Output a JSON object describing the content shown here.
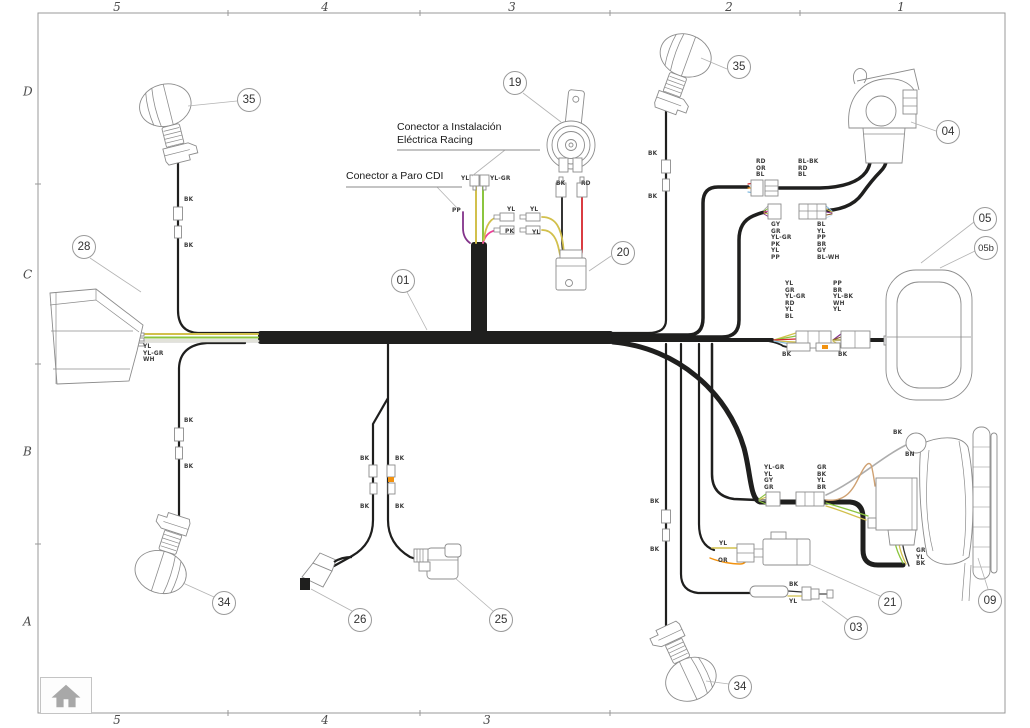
{
  "colors": {
    "BK": "#1f1f1e",
    "YL": "#d2c04c",
    "YL-GR": "#8bc53f",
    "YL-BK": "#9a8a22",
    "WH": "#f2f1ea",
    "RD": "#d6272e",
    "OR": "#f2920f",
    "PP": "#83338a",
    "PK": "#ec3f97",
    "BL": "#85bbdf",
    "BL-WH": "#cfe3f2",
    "BN": "#cfa172",
    "BR": "#8b5a2b",
    "GY": "#adadad",
    "outline": "#8c8c8c",
    "leader": "#b3b3b3",
    "frame": "#999999",
    "note-line": "#8a8a8a",
    "wh-edge": "#b5b5ad"
  },
  "frame": {
    "grid_top": [
      {
        "label": "5",
        "x": 117
      },
      {
        "label": "4",
        "x": 325
      },
      {
        "label": "3",
        "x": 512
      },
      {
        "label": "2",
        "x": 729
      },
      {
        "label": "1",
        "x": 901
      }
    ],
    "grid_bottom": [
      {
        "label": "5",
        "x": 117
      },
      {
        "label": "4",
        "x": 325
      },
      {
        "label": "3",
        "x": 487
      }
    ],
    "grid_left": [
      {
        "label": "D",
        "y": 92
      },
      {
        "label": "C",
        "y": 275
      },
      {
        "label": "B",
        "y": 452
      },
      {
        "label": "A",
        "y": 622
      }
    ]
  },
  "notes": [
    {
      "name": "note-racing",
      "text": "Conector a Instalación\nEléctrica Racing",
      "x": 397,
      "y": 121
    },
    {
      "name": "note-paro-cdi",
      "text": "Conector a Paro CDI",
      "x": 346,
      "y": 170
    }
  ],
  "callouts": [
    {
      "label": "35",
      "x": 249,
      "y": 100
    },
    {
      "label": "19",
      "x": 515,
      "y": 83
    },
    {
      "label": "35",
      "x": 739,
      "y": 67
    },
    {
      "label": "04",
      "x": 948,
      "y": 132
    },
    {
      "label": "28",
      "x": 84,
      "y": 247
    },
    {
      "label": "05",
      "x": 985,
      "y": 219
    },
    {
      "label": "05b",
      "x": 986,
      "y": 248
    },
    {
      "label": "20",
      "x": 623,
      "y": 253
    },
    {
      "label": "01",
      "x": 403,
      "y": 281
    },
    {
      "label": "34",
      "x": 224,
      "y": 603
    },
    {
      "label": "26",
      "x": 360,
      "y": 620
    },
    {
      "label": "25",
      "x": 501,
      "y": 620
    },
    {
      "label": "03",
      "x": 856,
      "y": 628
    },
    {
      "label": "21",
      "x": 890,
      "y": 603
    },
    {
      "label": "09",
      "x": 990,
      "y": 601
    },
    {
      "label": "34",
      "x": 740,
      "y": 687
    }
  ],
  "wire_labels": [
    {
      "text": "BK",
      "x": 184,
      "y": 197
    },
    {
      "text": "BK",
      "x": 184,
      "y": 243
    },
    {
      "text": "YL\nYL-GR\nWH",
      "x": 143,
      "y": 344
    },
    {
      "text": "BK",
      "x": 184,
      "y": 418
    },
    {
      "text": "BK",
      "x": 184,
      "y": 464
    },
    {
      "text": "YL",
      "x": 461,
      "y": 176
    },
    {
      "text": "YL-GR",
      "x": 490,
      "y": 176
    },
    {
      "text": "PP",
      "x": 452,
      "y": 208
    },
    {
      "text": "YL",
      "x": 507,
      "y": 207
    },
    {
      "text": "PK",
      "x": 505,
      "y": 229
    },
    {
      "text": "YL",
      "x": 530,
      "y": 207
    },
    {
      "text": "YL",
      "x": 532,
      "y": 230
    },
    {
      "text": "BK",
      "x": 556,
      "y": 181
    },
    {
      "text": "RD",
      "x": 581,
      "y": 181
    },
    {
      "text": "BK",
      "x": 648,
      "y": 151
    },
    {
      "text": "BK",
      "x": 648,
      "y": 194
    },
    {
      "text": "RD\nOR\nBL",
      "x": 756,
      "y": 159
    },
    {
      "text": "BL-BK\nRD\nBL",
      "x": 798,
      "y": 159
    },
    {
      "text": "GY\nGR\nYL-GR\nPK\nYL\nPP",
      "x": 771,
      "y": 222
    },
    {
      "text": "BL\nYL\nPP\nBR\nGY\nBL-WH",
      "x": 817,
      "y": 222
    },
    {
      "text": "YL\nGR\nYL-GR\nRD\nYL\nBL",
      "x": 785,
      "y": 281
    },
    {
      "text": "PP\nBR\nYL-BK\nWH\nYL",
      "x": 833,
      "y": 281
    },
    {
      "text": "BK",
      "x": 782,
      "y": 352
    },
    {
      "text": "BK",
      "x": 838,
      "y": 352
    },
    {
      "text": "YL-GR\nYL\nGY\nGR",
      "x": 764,
      "y": 465
    },
    {
      "text": "GR\nBK\nYL\nBR",
      "x": 817,
      "y": 465
    },
    {
      "text": "BK",
      "x": 893,
      "y": 430
    },
    {
      "text": "BN",
      "x": 905,
      "y": 452
    },
    {
      "text": "GR\nYL\nBK",
      "x": 916,
      "y": 548
    },
    {
      "text": "BK",
      "x": 650,
      "y": 499
    },
    {
      "text": "BK",
      "x": 650,
      "y": 547
    },
    {
      "text": "BK",
      "x": 360,
      "y": 456
    },
    {
      "text": "BK",
      "x": 395,
      "y": 456
    },
    {
      "text": "BK",
      "x": 360,
      "y": 504
    },
    {
      "text": "BK",
      "x": 395,
      "y": 504
    },
    {
      "text": "YL",
      "x": 719,
      "y": 541
    },
    {
      "text": "OR",
      "x": 718,
      "y": 558
    },
    {
      "text": "BK",
      "x": 789,
      "y": 582
    },
    {
      "text": "YL",
      "x": 789,
      "y": 599
    }
  ],
  "home": {
    "icon": "home-icon"
  }
}
